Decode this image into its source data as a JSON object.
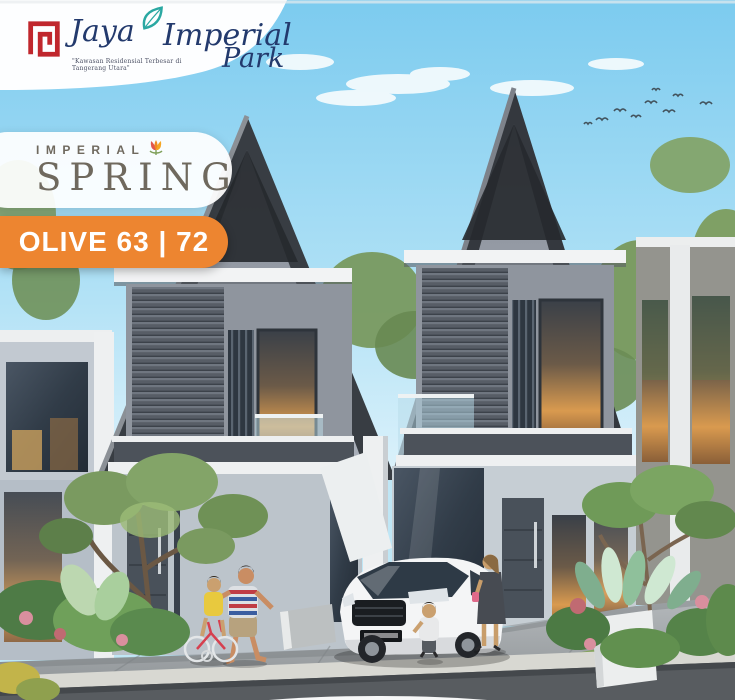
{
  "header": {
    "logo": {
      "icon": "red-maze-logo-icon",
      "leaf_icon": "teal-leaf-icon",
      "brand_first": "Jaya",
      "brand_second": "Imperial",
      "brand_third": "Park",
      "tagline": "\"Kawasan Residensial Terbesar di Tangerang Utara\""
    }
  },
  "badges": {
    "series": {
      "eyebrow": "IMPERIAL",
      "name": "SPRING",
      "icon": "tulip-icon"
    },
    "product": {
      "label": "OLIVE 63 | 72"
    }
  },
  "colors": {
    "brand_red": "#C0272D",
    "brand_navy": "#233A6D",
    "leaf_teal": "#2AA8A2",
    "badge_orange": "#ED8530",
    "series_text_gray": "#6F695E",
    "sky_blue": "#84CDEF",
    "roof_charcoal": "#33373C"
  },
  "scene": {
    "type": "architectural-rendering",
    "subject": "two modern two-storey houses with steep gable roofs and louvered facades",
    "elements": [
      "flying-birds",
      "white-hatchback-car",
      "father-teaching-daughter-bicycle",
      "mother-with-toddler",
      "tropical-planter-boxes",
      "street-and-driveway"
    ]
  }
}
